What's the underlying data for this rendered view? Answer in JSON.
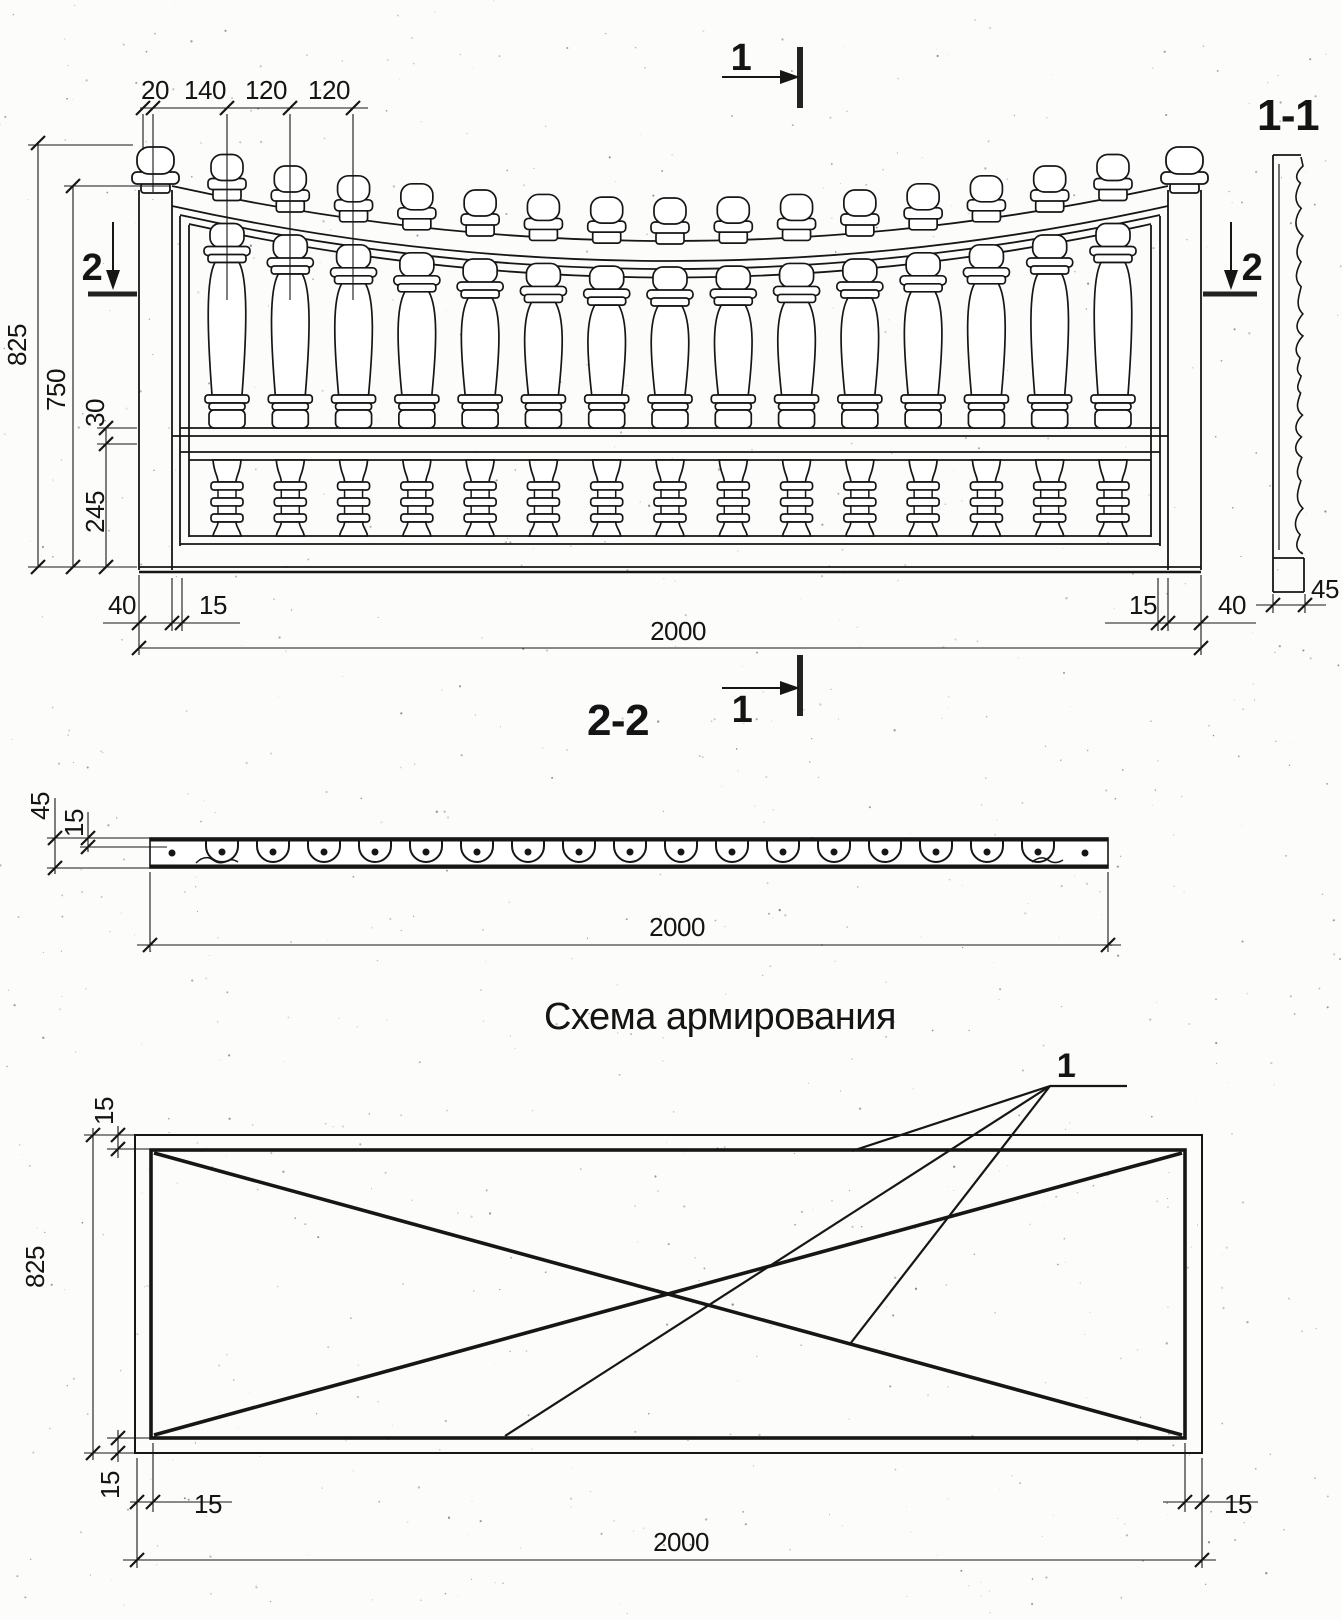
{
  "marks": {
    "cut1_top": "1",
    "cut1_bottom": "1",
    "cut2_left": "2",
    "cut2_right": "2",
    "view11": "1-1",
    "view22": "2-2",
    "rebar_callout": "1"
  },
  "elevation": {
    "top_dims": [
      "20",
      "140",
      "120",
      "120"
    ],
    "height_total": "825",
    "height_inner": "750",
    "band": "30",
    "lower_panel": "245",
    "bl_dims": [
      "40",
      "15"
    ],
    "br_dims": [
      "15",
      "40"
    ],
    "width": "2000",
    "profile_depth": "45"
  },
  "section22": {
    "depth": "45",
    "shell": "15",
    "width": "2000"
  },
  "scheme": {
    "title": "Схема армирования",
    "cover_top": "15",
    "height": "825",
    "cover_bottom": "15",
    "cover_left": "15",
    "cover_right": "15",
    "width": "2000"
  }
}
